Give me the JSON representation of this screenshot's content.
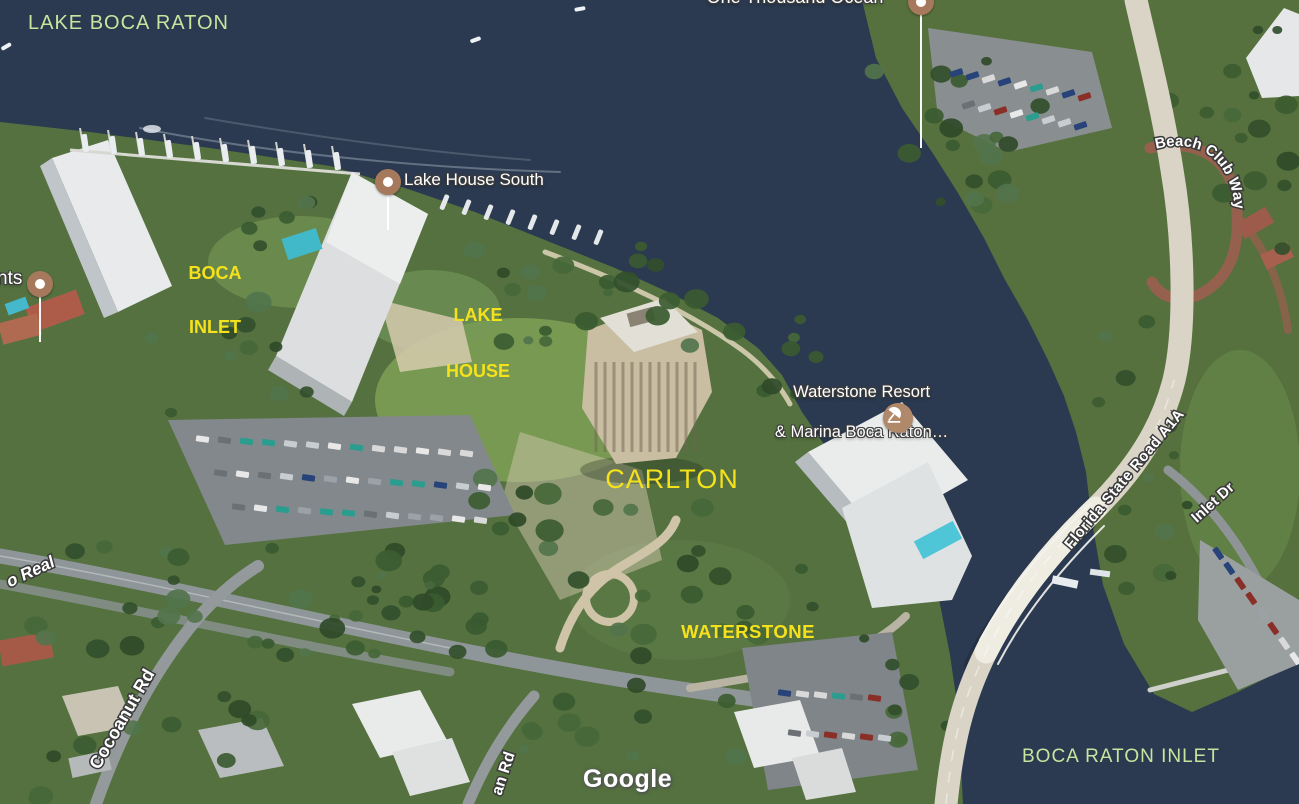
{
  "watermark": "Google",
  "water_labels": {
    "color": "#c9e49e",
    "lake_boca_raton": "LAKE BOCA RATON",
    "boca_raton_inlet": "BOCA RATON INLET"
  },
  "placemarks": {
    "color": "#f5e11c",
    "boca_inlet_line1": "BOCA",
    "boca_inlet_line2": "INLET",
    "lake_house_line1": "LAKE",
    "lake_house_line2": "HOUSE",
    "carlton": "CARLTON",
    "waterstone": "WATERSTONE"
  },
  "pois": {
    "pin_color": "#a6795c",
    "one_thousand_ocean": "One Thousand Ocean",
    "lake_house_south": "Lake House South",
    "waterstone_resort_line1": "Waterstone Resort",
    "waterstone_resort_line2": "& Marina Boca Raton…",
    "left_edge_name_fragment": "nts",
    "resort_icon": "beach-umbrella-icon"
  },
  "road_labels": {
    "florida_a1a": "Florida State Road A1A",
    "beach_club_way": "Beach Club Way",
    "cocoanut_rd": "Cocoanut Rd",
    "camino_real_fragment": "o Real",
    "bottom_road_fragment": "an Rd",
    "inlet_dr": "Inlet Dr"
  }
}
